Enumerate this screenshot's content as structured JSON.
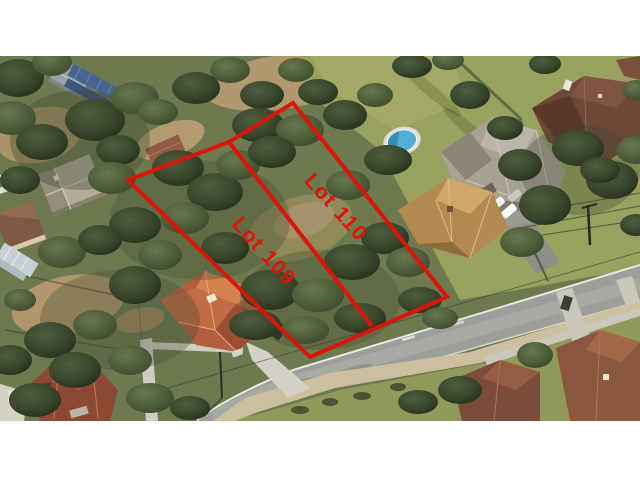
{
  "annotations": {
    "lots": [
      {
        "label": "Lot 109"
      },
      {
        "label": "Lot 110"
      }
    ],
    "outline_color": "#dc1508",
    "label_color": "#d8170c"
  },
  "scene_colors": {
    "letterbox_bars": "#ffffff",
    "pool_water": "#51aed4",
    "road_asphalt": "#9da09a",
    "lawn_green": "#99a15e",
    "tree_canopy": "#39462c",
    "terracotta_roof": "#b4603f",
    "gray_roof": "#a8a295",
    "brown_roof": "#6d4837",
    "dirt_tan": "#b29870"
  }
}
